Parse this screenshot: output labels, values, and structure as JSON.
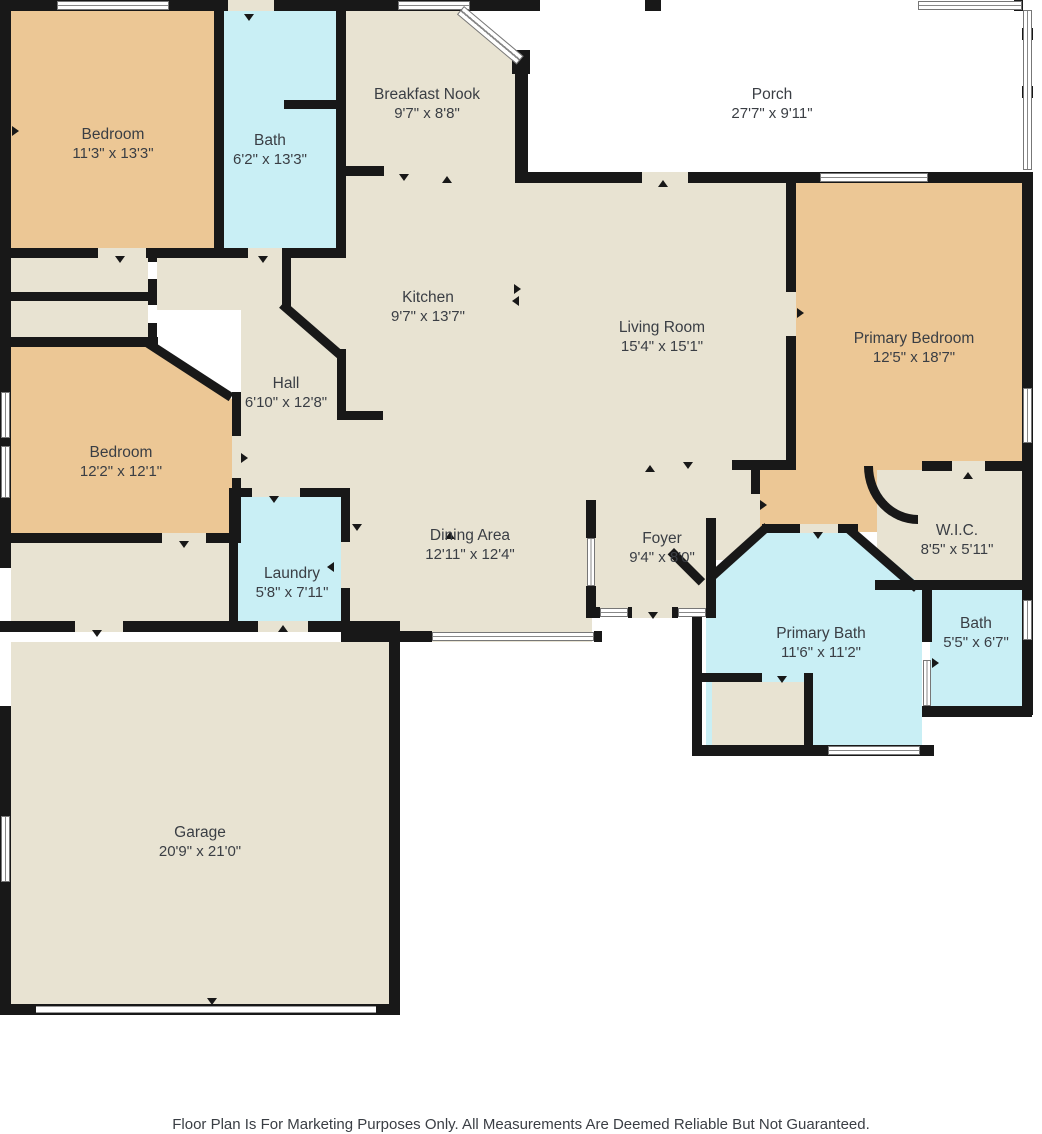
{
  "plan_type": "residential-floor-plan",
  "palette": {
    "wall": "#181818",
    "floor": "#e8e3d2",
    "bedroom_fill": "#ecc795",
    "wet_room_fill": "#c9eff5",
    "porch_fill": "#ffffff",
    "label_text": "#3a3e44"
  },
  "rooms": [
    {
      "name": "Bedroom",
      "dims": "11'3\" x 13'3\""
    },
    {
      "name": "Bath",
      "dims": "6'2\" x 13'3\""
    },
    {
      "name": "Breakfast Nook",
      "dims": "9'7\" x 8'8\""
    },
    {
      "name": "Porch",
      "dims": "27'7\" x 9'11\""
    },
    {
      "name": "Kitchen",
      "dims": "9'7\" x 13'7\""
    },
    {
      "name": "Living Room",
      "dims": "15'4\" x 15'1\""
    },
    {
      "name": "Primary Bedroom",
      "dims": "12'5\" x 18'7\""
    },
    {
      "name": "Hall",
      "dims": "6'10\" x 12'8\""
    },
    {
      "name": "Bedroom",
      "dims": "12'2\" x 12'1\""
    },
    {
      "name": "W.I.C.",
      "dims": "8'5\" x 5'11\""
    },
    {
      "name": "Dining Area",
      "dims": "12'11\" x 12'4\""
    },
    {
      "name": "Foyer",
      "dims": "9'4\" x 8'0\""
    },
    {
      "name": "Laundry",
      "dims": "5'8\" x 7'11\""
    },
    {
      "name": "Primary Bath",
      "dims": "11'6\" x 11'2\""
    },
    {
      "name": "Bath",
      "dims": "5'5\" x 6'7\""
    },
    {
      "name": "Garage",
      "dims": "20'9\" x 21'0\""
    }
  ],
  "footer": {
    "disclaimer": "Floor Plan Is For Marketing Purposes Only. All Measurements Are Deemed Reliable But Not Guaranteed."
  }
}
